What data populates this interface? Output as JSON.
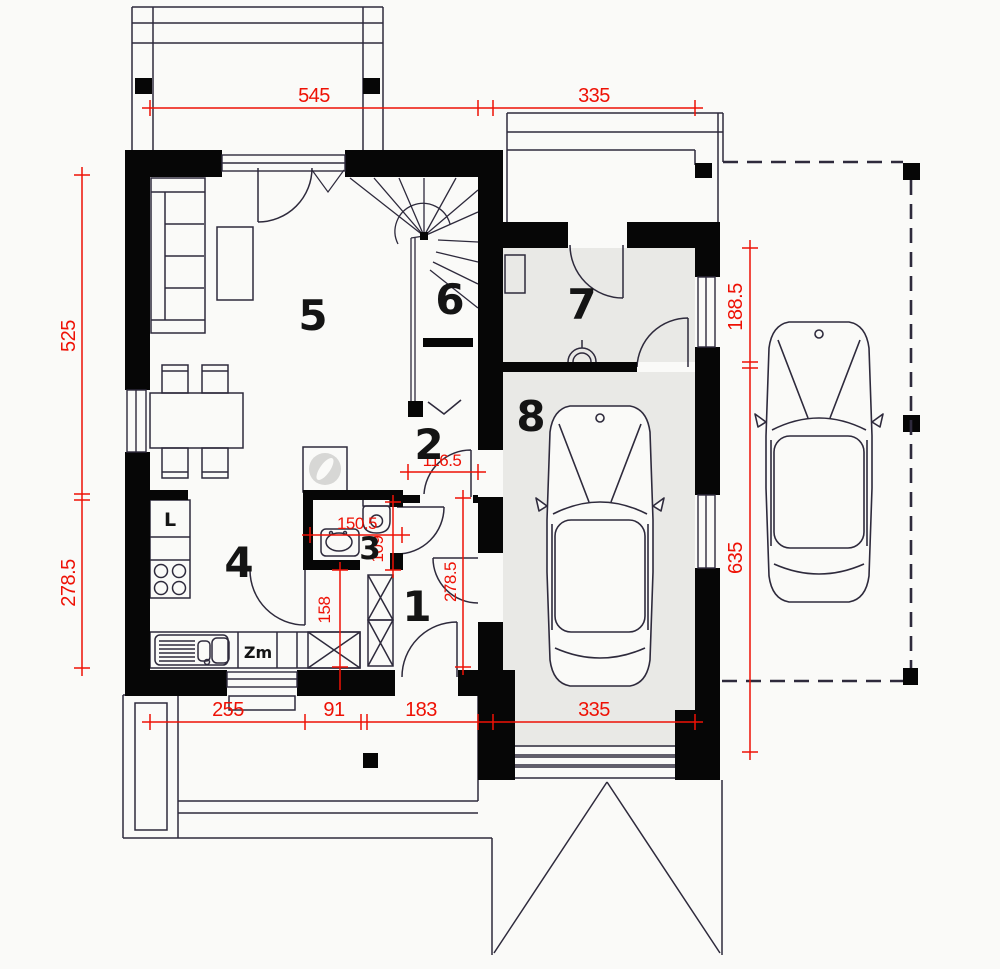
{
  "colors": {
    "wall": "#060606",
    "line": "#2e2a3c",
    "dim": "#ee1105",
    "room_fill": "#e9e9e6",
    "paper": "#fafaf8",
    "label": "#141414",
    "washer_drum": "#d7d7d5"
  },
  "rooms": {
    "r1": {
      "label": "1"
    },
    "r2": {
      "label": "2"
    },
    "r3": {
      "label": "3"
    },
    "r4": {
      "label": "4"
    },
    "r5": {
      "label": "5"
    },
    "r6": {
      "label": "6"
    },
    "r7": {
      "label": "7"
    },
    "r8": {
      "label": "8"
    }
  },
  "fixtures": {
    "fridge": "L",
    "dishwasher": "Zm"
  },
  "dims": {
    "top_a": "545",
    "top_b": "335",
    "left_a": "525",
    "left_b": "278.5",
    "right_a": "188.5",
    "right_b": "635",
    "bottom_a": "255",
    "bottom_b": "91",
    "bottom_c": "183",
    "bottom_d": "335",
    "hall_w": "116.5",
    "wc_w": "150.5",
    "wc_h": "109",
    "pass": "158",
    "hall_h": "278.5"
  }
}
